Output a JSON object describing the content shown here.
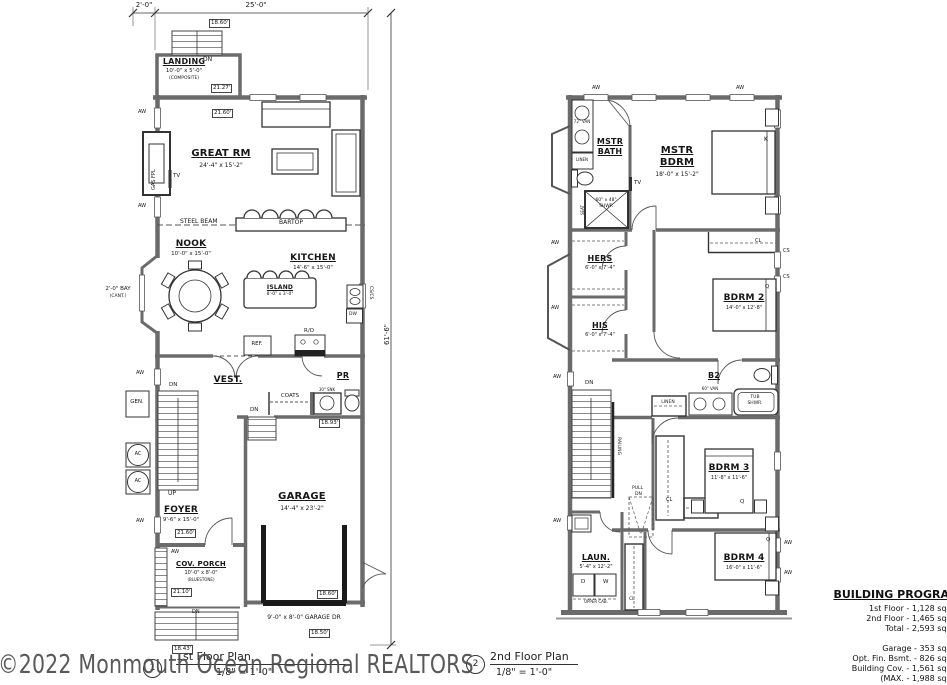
{
  "watermark": "©2022 Monmouth Ocean Regional REALTORS",
  "glyphs": {
    "aw": "AW",
    "dn": "DN",
    "up": "UP",
    "cl": "CL",
    "cs": "CS",
    "q": "Q",
    "k": "K",
    "tv": "TV",
    "ac": "AC",
    "d": "D",
    "w": "W"
  },
  "floor1": {
    "num": "1",
    "title": "1st Floor Plan",
    "scale": "1/8\" = 1'-0\"",
    "dims": {
      "top_left": "2'-0\"",
      "top": "25'-0\"",
      "right": "61'-6\""
    },
    "landing": {
      "name": "LANDING",
      "size": "10'-0\" x 5'-0\"",
      "note": "(COMPOSITE)"
    },
    "great": {
      "name": "GREAT RM",
      "size": "24'-4\" x 15'-2\""
    },
    "nook": {
      "name": "NOOK",
      "size": "10'-0\" x 15'-0\""
    },
    "kitchen": {
      "name": "KITCHEN",
      "size": "14'-6\" x 15'-0\""
    },
    "island": {
      "name": "ISLAND",
      "size": "8'-0\" x 3'-0\""
    },
    "vest": "VEST.",
    "pr": "PR",
    "coats": "COATS",
    "snk": "30\" SNK",
    "gen": "GEN.",
    "foyer": {
      "name": "FOYER",
      "size": "9'-6\" x 15'-0\""
    },
    "garage": {
      "name": "GARAGE",
      "size": "14'-4\" x 23'-2\"",
      "door": "9'-0\" x 8'-0\" GARAGE DR"
    },
    "porch": {
      "name": "COV. PORCH",
      "size": "10'-0\" x 8'-0\"",
      "note": "(BLUESTONE)"
    },
    "steel_beam": "STEEL BEAM",
    "bartop": "BARTOP",
    "bay1": "2'-0\" BAY",
    "bay2": "(CANT.)",
    "gas_fpl": "GAS FPL",
    "ref": "REF.",
    "ro": "R/O",
    "dw": "DW",
    "cscs": "CS/CS",
    "elev": {
      "e1": "18.60'",
      "e2": "21.27'",
      "e3": "21.60'",
      "e4": "18.93'",
      "e5": "21.60'",
      "e6": "21.10'",
      "e7": "18.60'",
      "e8": "18.50'",
      "e9": "18.43'"
    }
  },
  "floor2": {
    "num": "2",
    "title": "2nd Floor Plan",
    "scale": "1/8\" = 1'-0\"",
    "mbath": {
      "n1": "MSTR",
      "n2": "BATH",
      "van": "72\" VAN",
      "linen": "LINEN",
      "seat": "SEAT",
      "shwr1": "60\" x 48\"",
      "shwr2": "SHWR"
    },
    "mbdrm": {
      "n1": "MSTR",
      "n2": "BDRM",
      "size": "18'-0\" x 15'-2\""
    },
    "hers": {
      "name": "HERS",
      "size": "6'-0\" x 7'-4\""
    },
    "his": {
      "name": "HIS",
      "size": "6'-0\" x 7'-4\""
    },
    "bdrm2": {
      "name": "BDRM 2",
      "size": "14'-0\" x 12'-8\""
    },
    "b2": {
      "name": "B2",
      "linen": "LINEN",
      "van": "60\" VAN",
      "tub1": "TUB",
      "tub2": "SHWR."
    },
    "stairs": {
      "railing": "RAILING",
      "pull1": "PULL",
      "pull2": "DN"
    },
    "bdrm3": {
      "name": "BDRM 3",
      "size": "11'-8\" x 11'-6\""
    },
    "laun": {
      "name": "LAUN.",
      "size": "5'-4\" x 12'-2\"",
      "upper": "UPPER CAB."
    },
    "bdrm4": {
      "name": "BDRM 4",
      "size": "16'-0\" x 11'-6\""
    }
  },
  "program": {
    "title": "BUILDING PROGRAM",
    "g1": [
      "1st Floor - 1,128 sq. ft.",
      "2nd Floor - 1,465 sq. ft.",
      "Total - 2,593 sq. ft."
    ],
    "g2": [
      "Garage - 353 sq. ft.",
      "Opt. Fin. Bsmt. - 826 sq. ft.",
      "Building Cov. - 1,561 sq. ft.",
      "(MAX. - 1,988 sq. ft."
    ]
  }
}
